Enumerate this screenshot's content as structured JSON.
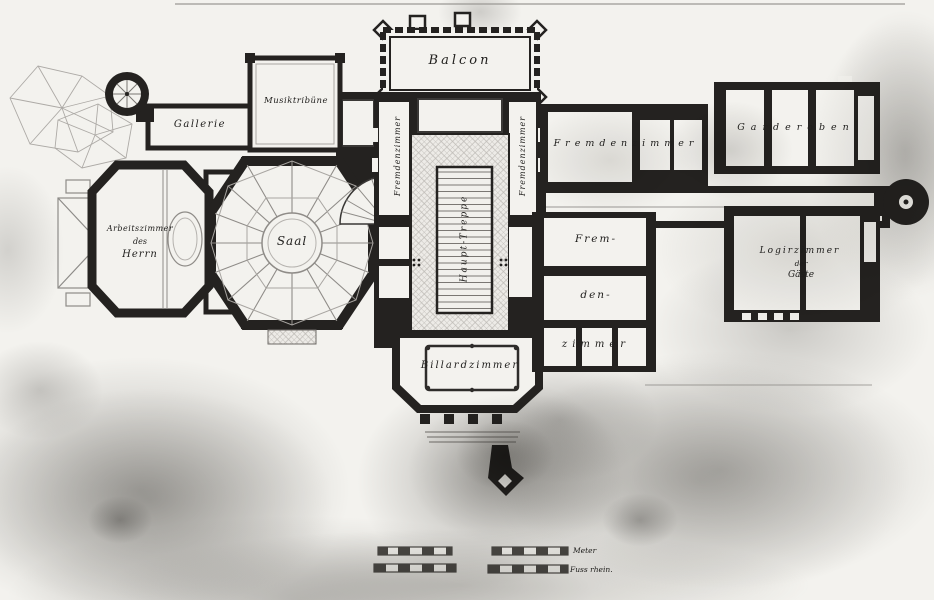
{
  "image": {
    "description": "Photograph of a historic hand-drawn ground-floor plan of a villa with German cursive room labels, aged paper with gray stains",
    "colors": {
      "paper": "#f3f2ee",
      "ink": "#242220",
      "stain": "#8a8885",
      "pencil": "#adaaa6"
    }
  },
  "plan": {
    "labels": {
      "balcon": "Balcon",
      "musiktribuene": "Musiktribüne",
      "gallerie": "Gallerie",
      "arbeitszimmer_l1": "Arbeitszimmer",
      "arbeitszimmer_l2": "des",
      "arbeitszimmer_l3": "Herrn",
      "saal": "Saal",
      "fremdenzimmer_vert_left": "Fremdenzimmer",
      "fremdenzimmer_vert_right": "Fremdenzimmer",
      "haupt_treppe": "Haupt-Treppe",
      "fremdenzimmer_top": "Fremdenzimmer",
      "garderoben": "Garderoben",
      "fremdenzimmer_stack_l1": "Frem-",
      "fremdenzimmer_stack_l2": "den-",
      "fremdenzimmer_stack_l3": "zimmer",
      "billardzimmer": "Billardzimmer",
      "logirzimmer_l1": "Logirzimmer",
      "logirzimmer_l2": "der",
      "logirzimmer_l3": "Gäste"
    },
    "scale_bars": {
      "meter": "Meter",
      "fuss": "Fuss rhein."
    }
  }
}
